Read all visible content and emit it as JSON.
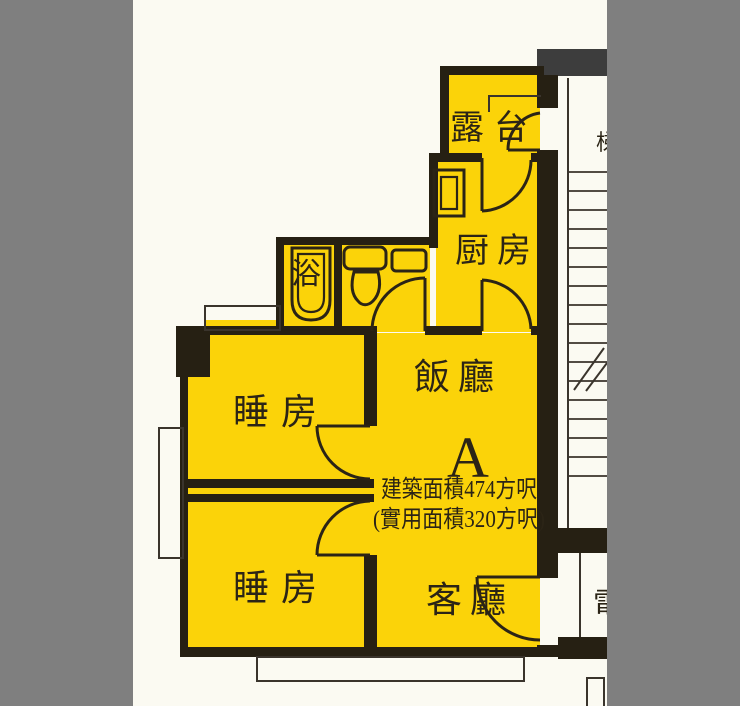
{
  "colors": {
    "surround": "#7f7f7f",
    "paper": "#fbfaf2",
    "room": "#fbd309",
    "wall": "#262013",
    "band": "#3d3d3d",
    "ink": "#2b2416",
    "thin": "#3a342c"
  },
  "unit": {
    "label": "A",
    "rooms": {
      "balcony": "露台",
      "kitchen": "厨房",
      "bath": "浴",
      "bedroom1": "睡房",
      "bedroom2": "睡房",
      "dining": "飯廳",
      "living": "客廳"
    },
    "area_line1": "建築面積474方呎",
    "area_line2": "(實用面積320方呎)"
  },
  "edge_fragments": {
    "top": "梯",
    "bottom": "電"
  }
}
